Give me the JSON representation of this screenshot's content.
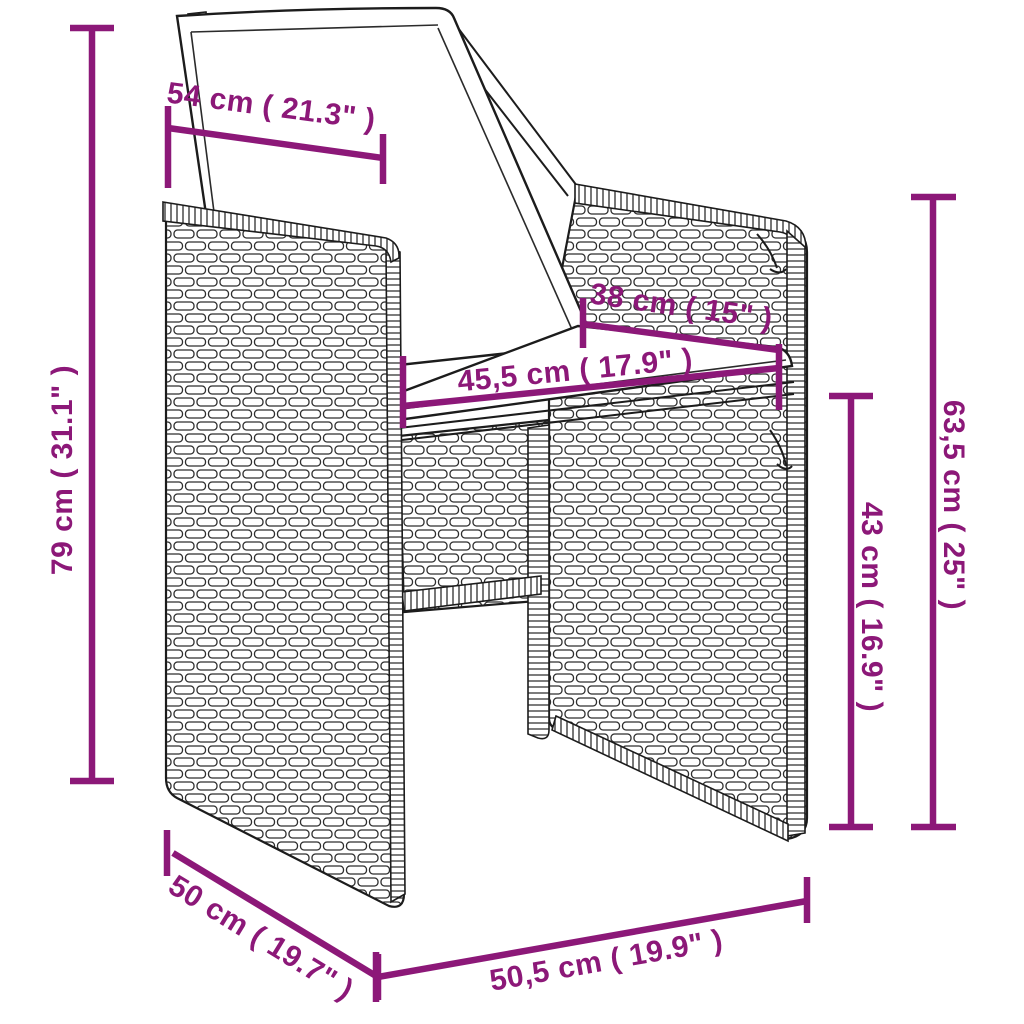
{
  "diagram": {
    "subject": "wicker-armchair-with-cushions",
    "colors": {
      "accent": "#8C1878",
      "line_art": "#1C1C1C",
      "cushion": "#FFFFFF",
      "background": "#FFFFFF"
    },
    "dimensions": {
      "backrest_width": "54 cm ( 21.3\" )",
      "total_height": "79 cm ( 31.1\" )",
      "backrest_depth": "38 cm ( 15\" )",
      "seat_width": "45,5 cm ( 17.9\" )",
      "armrest_height": "63,5 cm ( 25\" )",
      "seat_height": "43 cm ( 16.9\" )",
      "seat_depth": "50 cm ( 19.7\" )",
      "base_width": "50,5 cm ( 19.9\" )"
    }
  }
}
